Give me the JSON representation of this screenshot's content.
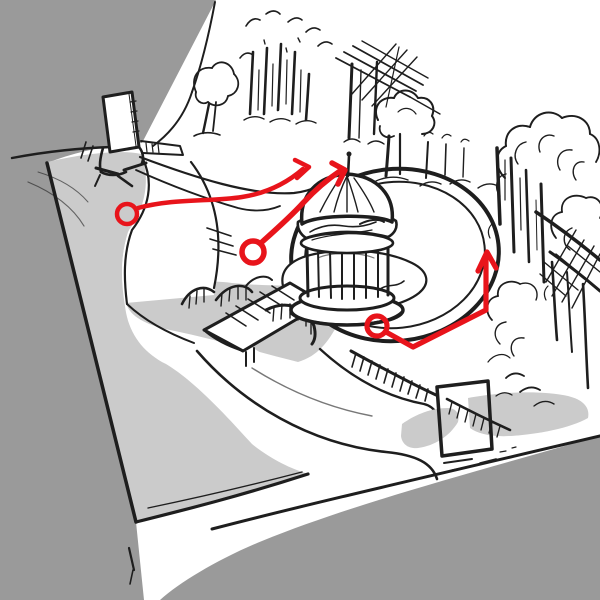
{
  "scene": {
    "title": "Park gazebo route sketch",
    "medium": "hand-drawn ink sketch with red route annotations",
    "description": "Isometric hand-drawn sketch of a park: a paved plaza with an entrance signpost, walking paths, an arched footbridge over a stream, a domed gazebo on an island in a round pond, background trees, lattice fences, and a gate frame with stair railings. Three red route markers (circled start points with direction arrows) are drawn on top."
  },
  "colors": {
    "background": "#9a9a9a",
    "terrain": "#ffffff",
    "surface": "#cbcbcb",
    "ink": "#1e1e1e",
    "annotation_red": "#e8141b"
  },
  "landmarks": {
    "plaza": "Paved plaza",
    "entrance_post": "Entrance signpost",
    "paths": "Walking paths",
    "stream": "Stream",
    "footbridge": "Arched footbridge",
    "pond": "Round pond",
    "island": "Gazebo island",
    "gazebo": "Domed gazebo",
    "trees_top": "Background trees",
    "trellis": "Trellis and tree",
    "trees_right": "Right-side trees",
    "lattice_right": "Lattice fence",
    "gate": "Gate frame with stair railing",
    "routes": "Red route markers"
  },
  "annotations": {
    "color": "#e8141b",
    "style": "circle-start-with-arrow",
    "markers": [
      {
        "name": "route-marker-1",
        "lw": 4.5,
        "circle": {
          "cx": 127,
          "cy": 214,
          "r": 10
        },
        "line": "M138,208 C175,198 212,202 242,197 C268,193 288,182 303,169",
        "arrow": "M295,160 L309,167 L297,178"
      },
      {
        "name": "route-marker-2",
        "lw": 5.5,
        "circle": {
          "cx": 253,
          "cy": 252,
          "r": 11
        },
        "line": "M262,242 C280,226 294,213 303,203 C316,189 328,179 340,171",
        "arrow": "M332,163 L345,170 L338,184"
      },
      {
        "name": "route-marker-3",
        "lw": 5.2,
        "circle": {
          "cx": 377,
          "cy": 326,
          "r": 10
        },
        "line": "M386,332 L413,347 L486,310 L486,258",
        "arrow": "M478,271 L487,252 L496,268"
      }
    ]
  }
}
